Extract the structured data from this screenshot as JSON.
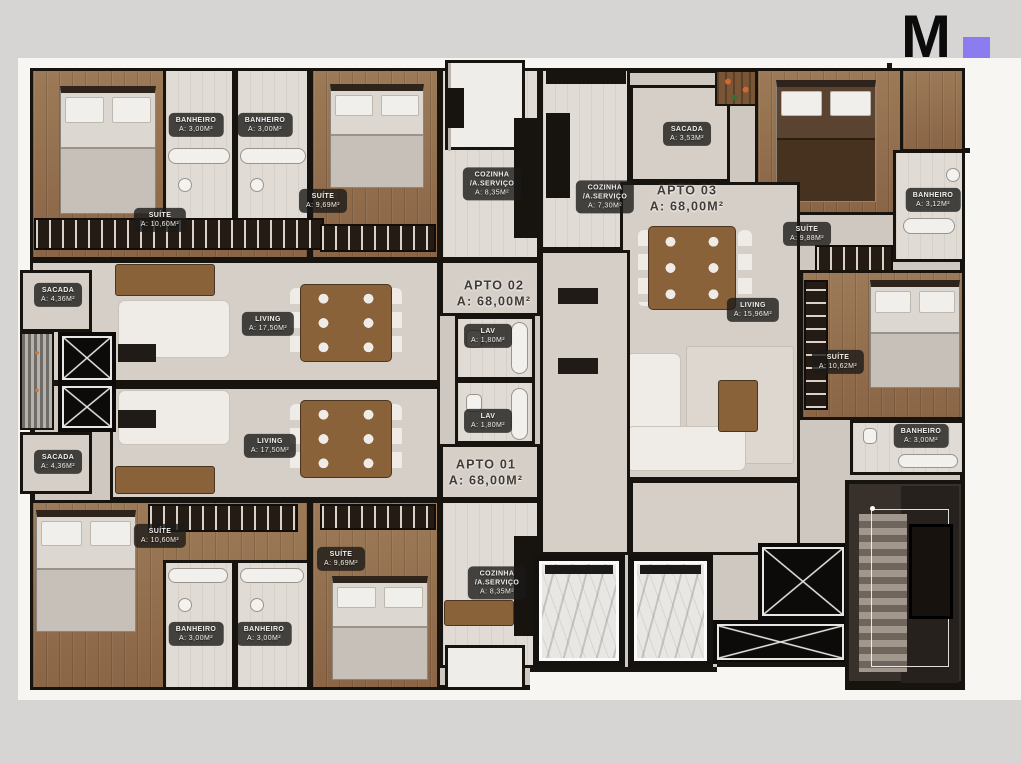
{
  "logo": {
    "letter": "M",
    "accent_color": "#8b7cf0"
  },
  "colors": {
    "background": "#d6d5d3",
    "photo": "#f8f6f3",
    "wall": "#17130f",
    "wood_floor": "#93704f",
    "tile_floor": "#d6cfc7",
    "accent_purple": "#8b7cf0"
  },
  "labels": [
    {
      "name": "BANHEIRO",
      "area": "A: 3,00M²"
    },
    {
      "name": "BANHEIRO",
      "area": "A: 3,00M²"
    },
    {
      "name": "SUÍTE",
      "area": "A: 10,60M²"
    },
    {
      "name": "SUÍTE",
      "area": "A: 9,69M²"
    },
    {
      "name": "COZINHA\n/A.SERVIÇO",
      "area": "A: 8,35M²"
    },
    {
      "name": "COZINHA\n/A.SERVIÇO",
      "area": "A: 7,30M²"
    },
    {
      "name": "SACADA",
      "area": "A: 3,53M²"
    },
    {
      "name": "APTO 03",
      "area": "A: 68,00M²"
    },
    {
      "name": "BANHEIRO",
      "area": "A: 3,12M²"
    },
    {
      "name": "SUÍTE",
      "area": "A: 9,88M²"
    },
    {
      "name": "SACADA",
      "area": "A: 4,36M²"
    },
    {
      "name": "LIVING",
      "area": "A: 17,50M²"
    },
    {
      "name": "APTO 02",
      "area": "A: 68,00M²"
    },
    {
      "name": "LAV",
      "area": "A: 1,80M²"
    },
    {
      "name": "LIVING",
      "area": "A: 15,96M²"
    },
    {
      "name": "SUÍTE",
      "area": "A: 10,62M²"
    },
    {
      "name": "LAV",
      "area": "A: 1,80M²"
    },
    {
      "name": "BANHEIRO",
      "area": "A: 3,00M²"
    },
    {
      "name": "SACADA",
      "area": "A: 4,36M²"
    },
    {
      "name": "LIVING",
      "area": "A: 17,50M²"
    },
    {
      "name": "APTO 01",
      "area": "A: 68,00M²"
    },
    {
      "name": "SUÍTE",
      "area": "A: 10,60M²"
    },
    {
      "name": "SUÍTE",
      "area": "A: 9,69M²"
    },
    {
      "name": "COZINHA\n/A.SERVIÇO",
      "area": "A: 8,35M²"
    },
    {
      "name": "BANHEIRO",
      "area": "A: 3,00M²"
    },
    {
      "name": "BANHEIRO",
      "area": "A: 3,00M²"
    }
  ]
}
